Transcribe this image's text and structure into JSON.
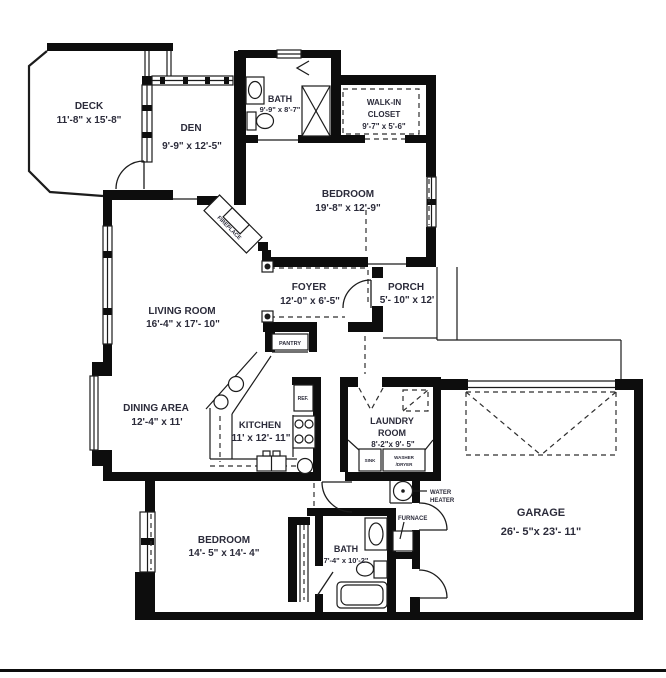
{
  "document": {
    "type": "residential floor plan"
  },
  "colors": {
    "wall": "#0d0d0d",
    "line": "#1c1c1c",
    "text": "#2b2b3a",
    "background": "#ffffff"
  },
  "rooms": {
    "deck": {
      "name": "DECK",
      "dims": "11'-8\" x 15'-8\""
    },
    "den": {
      "name": "DEN",
      "dims": "9'-9\" x 12'-5\""
    },
    "bath_upper": {
      "name": "BATH",
      "dims": "9'-9\" x 8'-7\""
    },
    "walkin_closet": {
      "name_line1": "WALK-IN",
      "name_line2": "CLOSET",
      "dims": "9'-7\" x 5'-6\""
    },
    "bedroom_upper": {
      "name": "BEDROOM",
      "dims": "19'-8\" x 12'-9\""
    },
    "foyer": {
      "name": "FOYER",
      "dims": "12'-0\" x 6'-5\""
    },
    "porch": {
      "name": "PORCH",
      "dims": "5'- 10\" x 12'"
    },
    "living_room": {
      "name": "LIVING ROOM",
      "dims": "16'-4\" x 17'- 10\""
    },
    "dining_area": {
      "name": "DINING AREA",
      "dims": "12'-4\" x 11'"
    },
    "kitchen": {
      "name": "KITCHEN",
      "dims": "11' x 12'- 11\""
    },
    "laundry": {
      "name_line1": "LAUNDRY",
      "name_line2": "ROOM",
      "dims": "8'-2\"x 9'- 5\""
    },
    "bedroom_lower": {
      "name": "BEDROOM",
      "dims": "14'- 5\" x 14'- 4\""
    },
    "bath_lower": {
      "name": "BATH",
      "dims": "7'-4\" x 10'-2\""
    },
    "garage": {
      "name": "GARAGE",
      "dims": "26'- 5\"x 23'- 11\""
    }
  },
  "fixtures": {
    "pantry": "PANTRY",
    "refrigerator": "REF.",
    "sink": "SINK",
    "washer_line1": "WASHER",
    "washer_line2": "/DRYER",
    "water_heater_line1": "WATER",
    "water_heater_line2": "HEATER",
    "furnace": "FURNACE",
    "fireplace": "FIREPLACE"
  }
}
